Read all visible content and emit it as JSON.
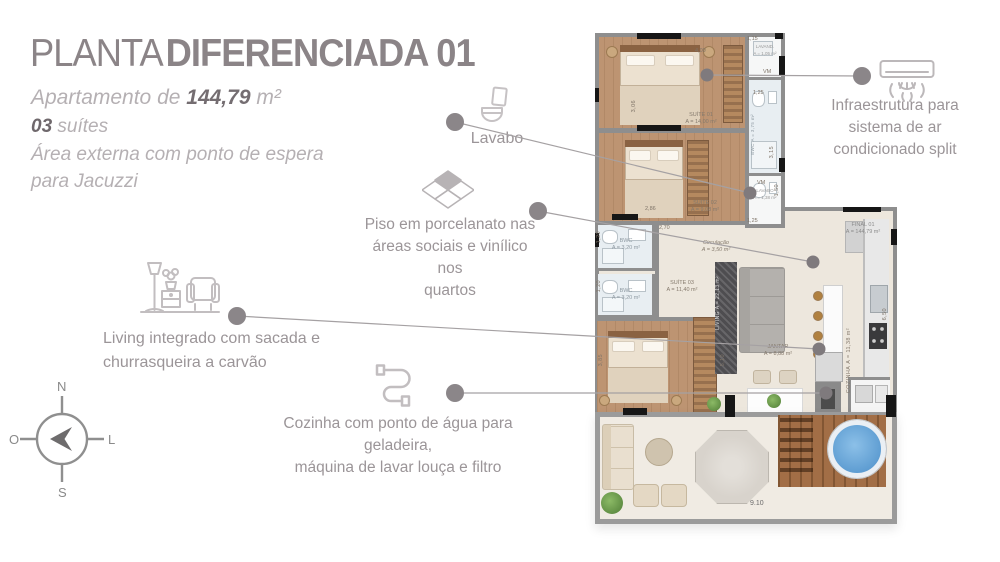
{
  "header": {
    "title_light": "PLANTA",
    "title_bold": "DIFERENCIADA 01",
    "apartment_prefix": "Apartamento de ",
    "apartment_area": "144,79",
    "apartment_suffix": " m²",
    "suites_count": "03",
    "suites_label": " suítes",
    "desc_line1": "Área externa com ponto de espera",
    "desc_line2": "para Jacuzzi"
  },
  "callouts": {
    "lavabo": {
      "label": "Lavabo"
    },
    "ac": {
      "line1": "Infraestrutura para",
      "line2": "sistema de ar",
      "line3": "condicionado split"
    },
    "piso": {
      "line1": "Piso em porcelanato nas",
      "line2": "áreas sociais e vinílico nos",
      "line3": "quartos"
    },
    "living": {
      "line1": "Living integrado com sacada e",
      "line2": "churrasqueira a carvão"
    },
    "cozinha": {
      "line1": "Cozinha com ponto de água para geladeira,",
      "line2": "máquina de lavar louça e filtro"
    }
  },
  "compass": {
    "n": "N",
    "s": "S",
    "o": "O",
    "l": "L"
  },
  "plan": {
    "rooms": {
      "suite1": {
        "name": "SUÍTE 01",
        "area": "A = 14,00 m²"
      },
      "suite2": {
        "name": "SUÍTE 02",
        "area": "A = 9,08 m²"
      },
      "suite3": {
        "name": "SUÍTE 03",
        "area": "A = 11,40 m²"
      },
      "bwc_suite": {
        "name": "BWC",
        "area": "A = 3,75 m²"
      },
      "bwc1": {
        "name": "BWC",
        "area": "A = 3,20 m²"
      },
      "bwc2": {
        "name": "BWC",
        "area": "A = 3,20 m²"
      },
      "lavand": {
        "name": "LAVAND.",
        "area": "A = 1,05 m²"
      },
      "lavabo": {
        "name": "LAVABO",
        "area": "A = 1,38 m²"
      },
      "circulacao": {
        "name": "Circulação",
        "area": "A = 3,50 m²"
      },
      "living": {
        "name": "LIVING",
        "area": "A = 22,13 m²"
      },
      "jantar": {
        "name": "JANTAR",
        "area": "A = 8,88 m²"
      },
      "cozinha": {
        "name": "COZINHA",
        "area": "A = 11,38 m²"
      },
      "final": {
        "name": "FINAL 01",
        "area": "A = 144,79 m²"
      }
    },
    "vm": "VM",
    "dims": {
      "d115": "1,15",
      "d125a": "1,25",
      "d315": "3,15",
      "d150": "1,50",
      "d125b": "1,25",
      "d400": "4,00",
      "d306": "3,06",
      "d286": "2,86",
      "d270": "2,70",
      "d120a": "1,20",
      "d120b": "1,20",
      "d385": "3,85",
      "d510": "5,10",
      "d650": "6,50",
      "d910": "9.10"
    }
  },
  "colors": {
    "title": "#8b8487",
    "text_muted": "#b5b0b3",
    "text_dark": "#6f686c",
    "callout_text": "#9b9598",
    "leader_line": "#a5a1a3",
    "dot": "#8b8689",
    "wall": "#8e8e8e",
    "wood_floor": "#bd9472",
    "social_floor": "#ede7dd",
    "bath_floor": "#e8eef2",
    "deck_wood": "#a26e46",
    "jacuzzi_water": "#5d9ed6"
  }
}
